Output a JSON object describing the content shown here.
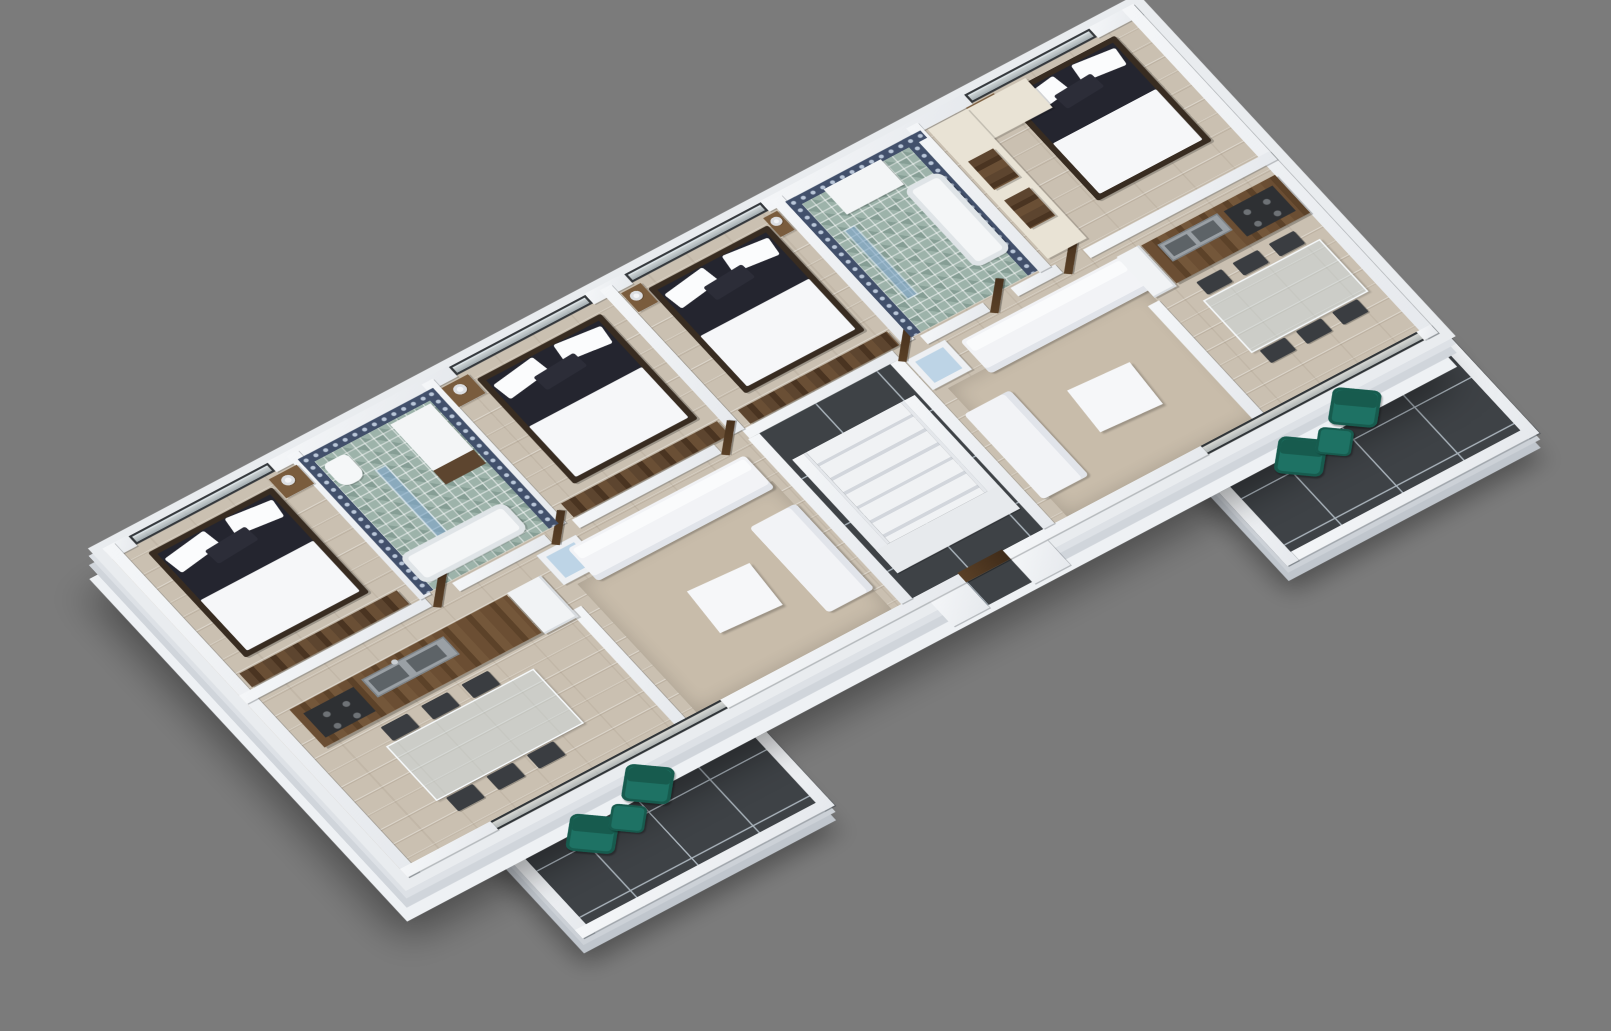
{
  "scene": {
    "type": "3d-isometric-floor-plan-render",
    "description": "Isometric 3D cutaway render of a residential floor with two mirrored apartments around a central staircase core, on a plain gray background",
    "view": "isometric",
    "has_text": false
  },
  "colors": {
    "background": "#7b7b7b",
    "slab": "#e9ecef",
    "wall": "#eef0f3",
    "wall_edge": "#c9ced4",
    "floor_wood": "#cac0b1",
    "wood_dark": "#5d452f",
    "wood_mid": "#7a5c3d",
    "tile_dark": "#3e4246",
    "tile_grout": "#aab4bc",
    "bed_dark": "#24252f",
    "textile": "#f6f7f9",
    "teal": "#1e7264",
    "teal_dark": "#175b4e",
    "glass": "#bdd4e6",
    "shower": "#7fa6c9",
    "pattern": "#42506b",
    "pattern_dot": "#b9c6d8",
    "mosaic": "#9db3aa",
    "cream": "#e9e3d5",
    "metal": "#9aa0a5",
    "cooktop": "#2e3033",
    "rug": "#c8bcaa"
  },
  "building": {
    "units": [
      {
        "name": "left-apartment",
        "rooms": [
          "bedroom-1",
          "bathroom-1",
          "bedroom-2",
          "kitchen-dining-1",
          "living-room-1",
          "balcony-1"
        ]
      },
      {
        "name": "right-apartment",
        "rooms": [
          "bedroom-3",
          "bathroom-2",
          "bedroom-4",
          "kitchen-dining-2",
          "living-room-2",
          "balcony-2"
        ]
      }
    ],
    "core": {
      "name": "stair-core",
      "floor": "dark-marble-tile",
      "features": [
        "white-staircase",
        "wood-entry-door",
        "entry-porch"
      ]
    }
  },
  "rooms": [
    {
      "name": "bedroom-1",
      "floor": "light-wood-plank",
      "furniture": [
        {
          "item": "double-bed",
          "count": 1,
          "style": "dark platform bed, white duvet and pillows"
        },
        {
          "item": "nightstand",
          "count": 1
        },
        {
          "item": "table-lamp",
          "count": 1
        },
        {
          "item": "wardrobe",
          "count": 1
        },
        {
          "item": "glass-balustrade-window",
          "count": 1
        }
      ]
    },
    {
      "name": "bathroom-1",
      "floor": "green-mosaic-tile",
      "walls": "navy-patterned-tile",
      "furniture": [
        {
          "item": "toilet",
          "count": 1
        },
        {
          "item": "washbasin-vanity",
          "count": 1
        },
        {
          "item": "glass-shower-screen",
          "count": 1
        },
        {
          "item": "bathtub",
          "count": 1
        }
      ]
    },
    {
      "name": "bedroom-2",
      "floor": "light-wood-plank",
      "furniture": [
        {
          "item": "double-bed",
          "count": 1
        },
        {
          "item": "nightstand",
          "count": 1
        },
        {
          "item": "table-lamp",
          "count": 1
        },
        {
          "item": "wardrobe",
          "count": 1
        },
        {
          "item": "glass-balustrade-window",
          "count": 1
        }
      ]
    },
    {
      "name": "kitchen-dining-1",
      "floor": "light-wood-plank",
      "furniture": [
        {
          "item": "kitchen-island",
          "count": 1,
          "style": "dark walnut"
        },
        {
          "item": "double-sink",
          "count": 1
        },
        {
          "item": "cooktop",
          "count": 1
        },
        {
          "item": "fridge",
          "count": 1
        },
        {
          "item": "glass-dining-table",
          "count": 1
        },
        {
          "item": "dining-chair",
          "count": 6
        },
        {
          "item": "sliding-glass-door",
          "count": 1
        }
      ]
    },
    {
      "name": "living-room-1",
      "floor": "light-wood-plank",
      "furniture": [
        {
          "item": "sofa",
          "count": 1,
          "style": "long white"
        },
        {
          "item": "chaise-lounge",
          "count": 1
        },
        {
          "item": "coffee-table",
          "count": 1
        },
        {
          "item": "area-rug",
          "count": 1
        },
        {
          "item": "skylight-box",
          "count": 1
        }
      ]
    },
    {
      "name": "balcony-1",
      "floor": "dark-marble-tile",
      "furniture": [
        {
          "item": "teal-armchair",
          "count": 2
        },
        {
          "item": "teal-ottoman",
          "count": 1
        },
        {
          "item": "white-parapet",
          "count": 1
        }
      ]
    },
    {
      "name": "stair-core",
      "floor": "dark-marble-tile",
      "furniture": [
        {
          "item": "staircase",
          "count": 1,
          "style": "white steps"
        },
        {
          "item": "entry-door",
          "count": 1,
          "style": "dark wood"
        }
      ]
    },
    {
      "name": "bedroom-3",
      "floor": "light-wood-plank",
      "furniture": [
        {
          "item": "double-bed",
          "count": 1
        },
        {
          "item": "nightstand",
          "count": 2
        },
        {
          "item": "table-lamp",
          "count": 2
        },
        {
          "item": "wardrobe",
          "count": 1
        },
        {
          "item": "glass-balustrade-window",
          "count": 1
        }
      ]
    },
    {
      "name": "bathroom-2",
      "floor": "green-mosaic-tile",
      "walls": "navy-patterned-tile",
      "furniture": [
        {
          "item": "washbasin",
          "count": 1
        },
        {
          "item": "bathtub",
          "count": 1
        },
        {
          "item": "glass-shower-screen",
          "count": 1
        }
      ]
    },
    {
      "name": "bedroom-4",
      "floor": "light-wood-plank",
      "furniture": [
        {
          "item": "double-bed",
          "count": 1
        },
        {
          "item": "nightstand",
          "count": 1
        },
        {
          "item": "table-lamp",
          "count": 1
        },
        {
          "item": "vanity-counter",
          "count": 1,
          "style": "cream marble with two dark wood basins"
        },
        {
          "item": "glass-balustrade-window",
          "count": 1
        }
      ]
    },
    {
      "name": "kitchen-dining-2",
      "floor": "light-wood-plank",
      "furniture": [
        {
          "item": "kitchen-island",
          "count": 1
        },
        {
          "item": "double-sink",
          "count": 1
        },
        {
          "item": "cooktop",
          "count": 1
        },
        {
          "item": "fridge",
          "count": 1
        },
        {
          "item": "glass-dining-table",
          "count": 1
        },
        {
          "item": "dining-chair",
          "count": 6
        },
        {
          "item": "sliding-glass-door",
          "count": 1
        }
      ]
    },
    {
      "name": "living-room-2",
      "floor": "light-wood-plank",
      "furniture": [
        {
          "item": "sofa",
          "count": 1
        },
        {
          "item": "chaise-lounge",
          "count": 1
        },
        {
          "item": "coffee-table",
          "count": 1
        },
        {
          "item": "area-rug",
          "count": 1
        },
        {
          "item": "skylight-box",
          "count": 1
        }
      ]
    },
    {
      "name": "balcony-2",
      "floor": "dark-marble-tile",
      "furniture": [
        {
          "item": "teal-armchair",
          "count": 2
        },
        {
          "item": "teal-ottoman",
          "count": 1
        },
        {
          "item": "white-parapet",
          "count": 1
        }
      ]
    }
  ]
}
